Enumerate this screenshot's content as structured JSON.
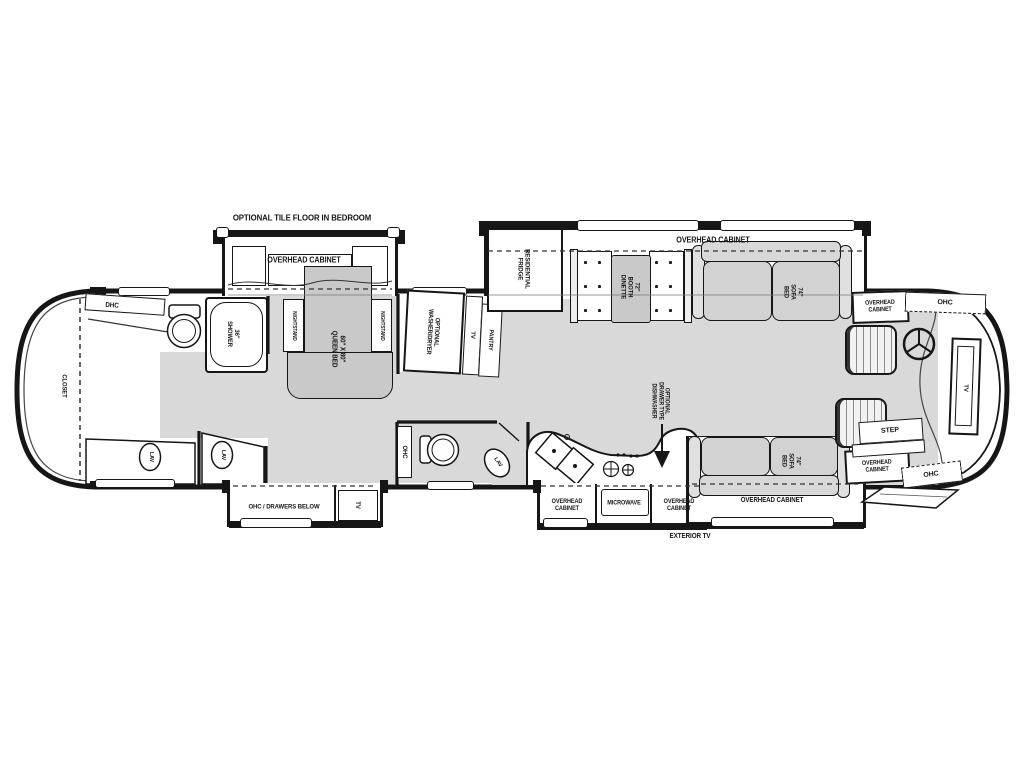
{
  "colors": {
    "background": "#ffffff",
    "outline": "#161616",
    "floor": "#d9d9d9",
    "furniture": "#c9c9c9",
    "cushion": "#d2d2d2",
    "thinline": "#555555"
  },
  "labels": {
    "title": "OPTIONAL TILE FLOOR IN BEDROOM",
    "oc_bedroom_slide": "OVERHEAD CABINET",
    "dhc_rear": "DHC",
    "closet": "CLOSET",
    "shower": "36\"\nSHOWER",
    "lav_bath": "LAV",
    "lav_vanity": "LAV",
    "nightstand_left": "NIGHTSTAND",
    "nightstand_right": "NIGHTSTAND",
    "queen_bed": "60\" X 80\"\nQUEEN BED",
    "ohc_drawers_below": "OHC / DRAWERS BELOW",
    "tv_bedroom": "TV",
    "washer_dryer": "OPTIONAL\nWASHER/DRYER",
    "tv_hall": "TV",
    "pantry": "PANTRY",
    "ohc_midbath": "OHC",
    "lav_midbath": "LAV",
    "fridge": "RESIDENTIAL\nFRIDGE",
    "oc_main_slide": "OVERHEAD CABINET",
    "dinette": "72\"\nBOOTH\nDINETTE",
    "sofa_top": "74\"\nSOFA\nBED",
    "dishwasher": "OPTIONAL\nDRAWER TYPE\nDISHWASHER",
    "oc_kitchen_left": "OVERHEAD\nCABINET",
    "microwave": "MICROWAVE",
    "oc_kitchen_right": "OVERHEAD\nCABINET",
    "sofa_bottom": "74\"\nSOFA\nBED",
    "oc_sofa_slide": "OVERHEAD CABINET",
    "exterior_tv": "EXTERIOR TV",
    "oc_front_top": "OVERHEAD\nCABINET",
    "ohc_front_top": "OHC",
    "oc_front_bottom": "OVERHEAD\nCABINET",
    "ohc_front_bottom": "OHC",
    "step": "STEP",
    "tv_front": "TV"
  }
}
